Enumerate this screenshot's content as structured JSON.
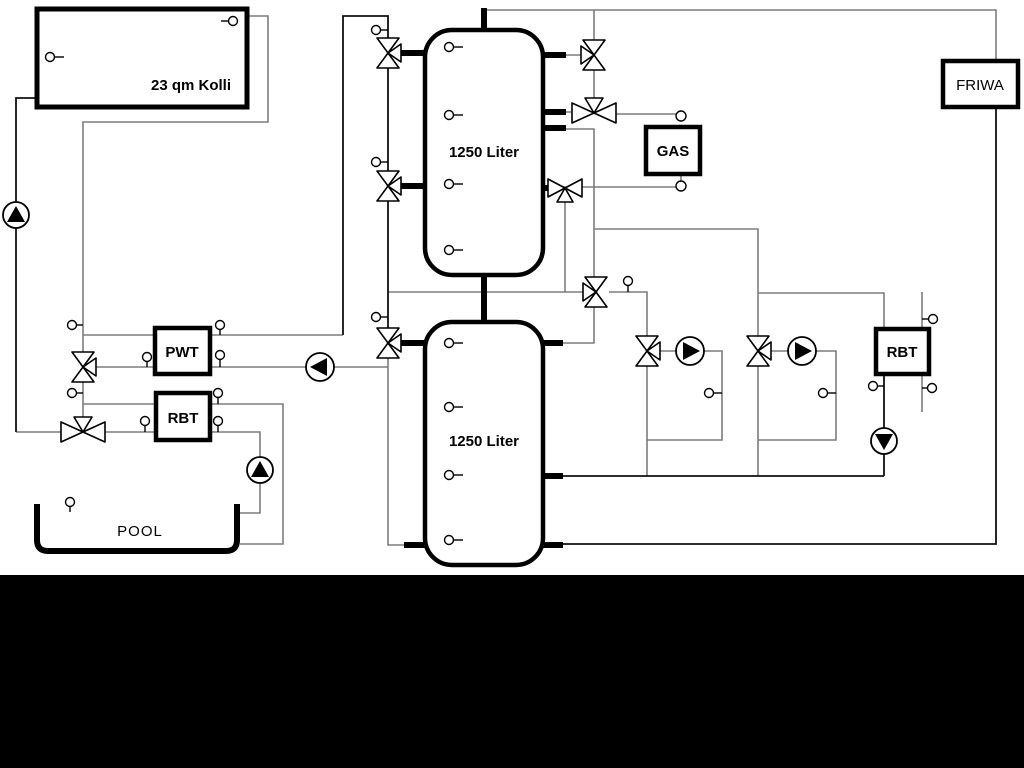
{
  "diagram": {
    "labels": {
      "collector": "23 qm Kolli",
      "tank_upper": "1250 Liter",
      "tank_lower": "1250 Liter",
      "gas": "GAS",
      "friwa": "FRIWA",
      "pwt": "PWT",
      "rbt_left": "RBT",
      "rbt_right": "RBT",
      "pool": "POOL"
    },
    "colors": {
      "pipe_gray": "#7d7d7d",
      "pipe_black": "#111111",
      "symbol_stroke": "#000000",
      "background": "#ffffff",
      "footer_bar": "#000000"
    },
    "components": {
      "pumps": [
        {
          "name": "solar-pump",
          "direction": "up"
        },
        {
          "name": "pwt-loop-pump",
          "direction": "left"
        },
        {
          "name": "pool-pump",
          "direction": "up"
        },
        {
          "name": "heating-circuit-1-pump",
          "direction": "right"
        },
        {
          "name": "heating-circuit-2-pump",
          "direction": "right"
        },
        {
          "name": "rbt-right-pump",
          "direction": "down"
        }
      ],
      "valves": [
        {
          "name": "tank-top-left-valve",
          "type": "3-way"
        },
        {
          "name": "tank-mid-left-valve",
          "type": "3-way"
        },
        {
          "name": "tank-lower-left-valve",
          "type": "3-way"
        },
        {
          "name": "solar-pwt-valve",
          "type": "3-way"
        },
        {
          "name": "pool-solar-valve",
          "type": "3-way"
        },
        {
          "name": "tank-top-right-valve",
          "type": "3-way"
        },
        {
          "name": "gas-supply-valve",
          "type": "3-way"
        },
        {
          "name": "gas-return-valve",
          "type": "3-way"
        },
        {
          "name": "mixing-valve",
          "type": "3-way"
        },
        {
          "name": "circuit-1-valve",
          "type": "3-way"
        },
        {
          "name": "circuit-2-valve",
          "type": "3-way"
        }
      ],
      "heat_exchangers": [
        "PWT",
        "RBT",
        "RBT"
      ],
      "sensor_count": 30
    }
  }
}
